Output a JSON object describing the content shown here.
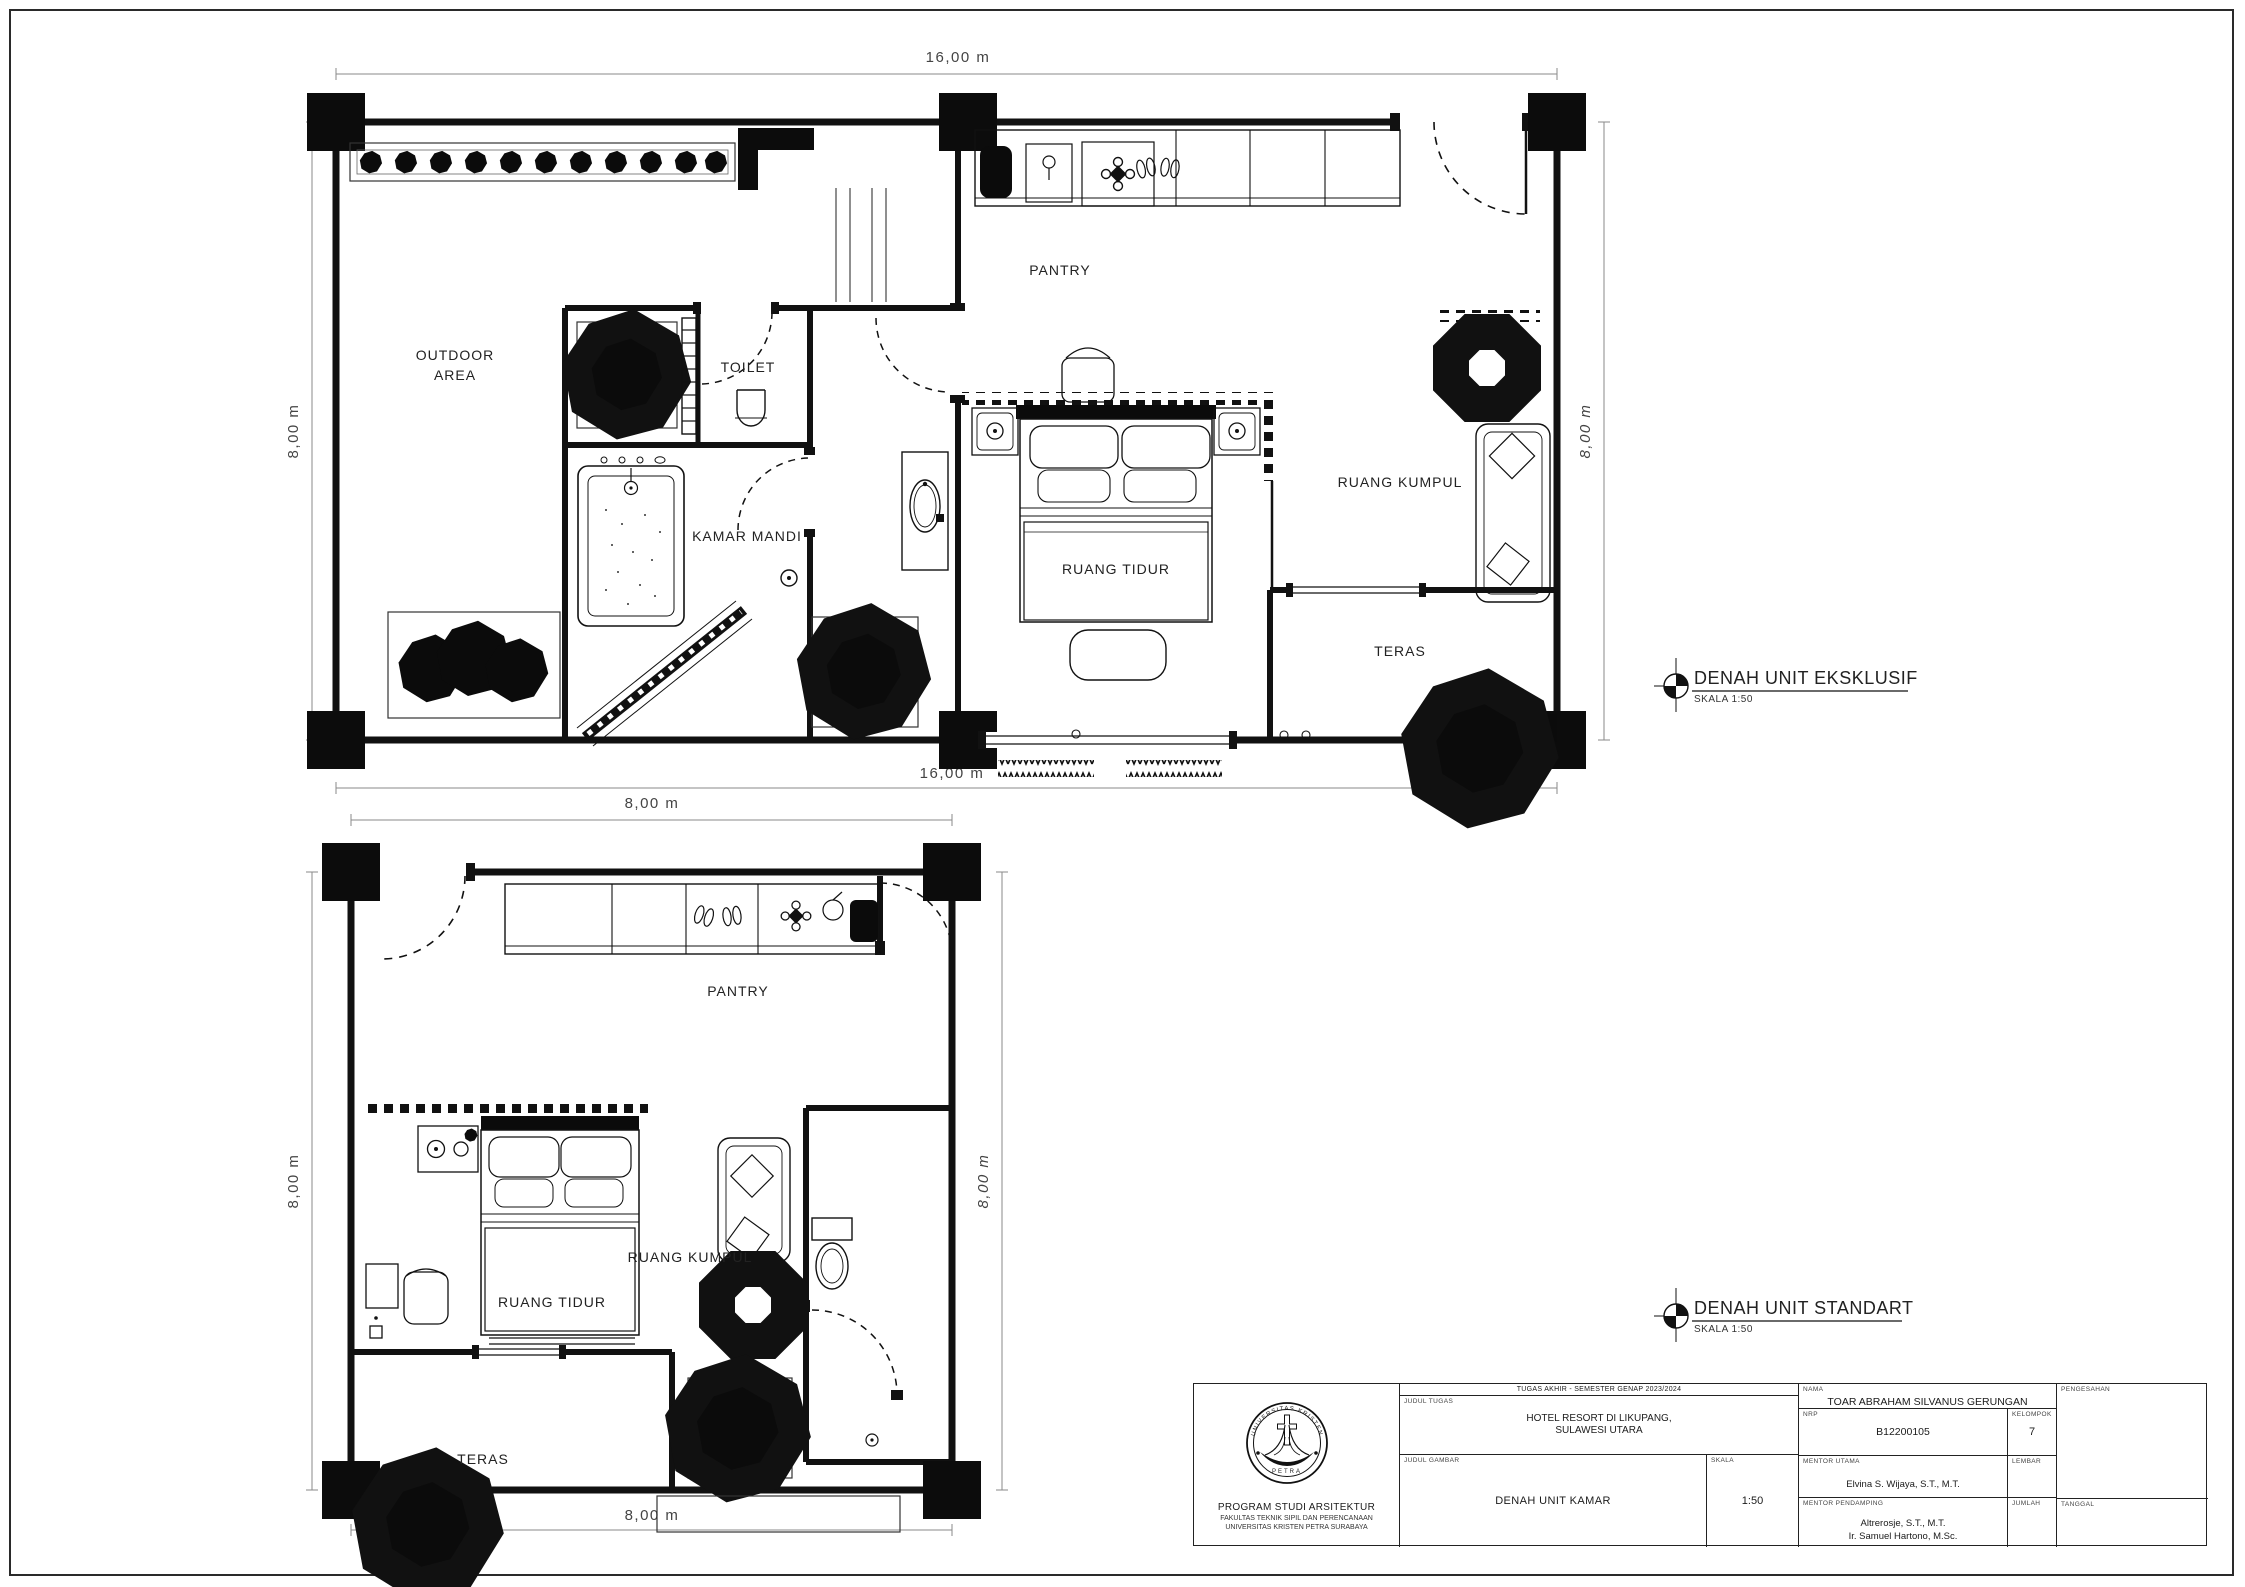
{
  "sheet": {
    "ink": "#1b1b1b",
    "paper": "#ffffff"
  },
  "plans": {
    "eksklusif": {
      "title": "DENAH UNIT EKSKLUSIF",
      "scale_note": "SKALA 1:50",
      "rooms": {
        "outdoor_line1": "OUTDOOR",
        "outdoor_line2": "AREA",
        "toilet": "TOILET",
        "kamar_mandi": "KAMAR MANDI",
        "pantry": "PANTRY",
        "ruang_tidur": "RUANG TIDUR",
        "ruang_kumpul": "RUANG KUMPUL",
        "teras": "TERAS"
      },
      "dims": {
        "top": "16,00 m",
        "bottom": "16,00 m",
        "left": "8,00 m",
        "right": "8,00 m"
      }
    },
    "standart": {
      "title": "DENAH UNIT STANDART",
      "scale_note": "SKALA 1:50",
      "rooms": {
        "pantry": "PANTRY",
        "ruang_tidur": "RUANG TIDUR",
        "ruang_kumpul": "RUANG KUMPUL",
        "teras": "TERAS"
      },
      "dims": {
        "top": "8,00 m",
        "bottom": "8,00 m",
        "left": "8,00 m",
        "right": "8,00 m"
      }
    }
  },
  "title_block": {
    "header": "TUGAS AKHIR - SEMESTER GENAP 2023/2024",
    "labels": {
      "judul_tugas": "JUDUL TUGAS",
      "judul_gambar": "JUDUL GAMBAR",
      "skala": "SKALA",
      "nama": "NAMA",
      "nrp": "NRP",
      "kelompok": "KELOMPOK",
      "mentor_utama": "MENTOR UTAMA",
      "mentor_pendamping": "MENTOR PENDAMPING",
      "lembar": "LEMBAR",
      "jumlah": "JUMLAH",
      "tanggal": "TANGGAL",
      "pengesahan": "PENGESAHAN"
    },
    "values": {
      "judul_tugas_line1": "HOTEL RESORT DI LIKUPANG,",
      "judul_tugas_line2": "SULAWESI UTARA",
      "judul_gambar": "DENAH UNIT KAMAR",
      "skala": "1:50",
      "nama": "TOAR ABRAHAM SILVANUS GERUNGAN",
      "nrp": "B12200105",
      "kelompok": "7",
      "mentor_utama": "Elvina S. Wijaya, S.T., M.T.",
      "mentor_pendamping_line1": "Altrerosje, S.T., M.T.",
      "mentor_pendamping_line2": "Ir. Samuel Hartono, M.Sc."
    },
    "institution": {
      "line1": "PROGRAM STUDI ARSITEKTUR",
      "line2": "FAKULTAS TEKNIK SIPIL DAN PERENCANAAN",
      "line3": "UNIVERSITAS KRISTEN PETRA SURABAYA"
    },
    "logo": {
      "top_text": "UNIVERSITAS KRISTEN",
      "bottom_text": "PETRA"
    }
  }
}
